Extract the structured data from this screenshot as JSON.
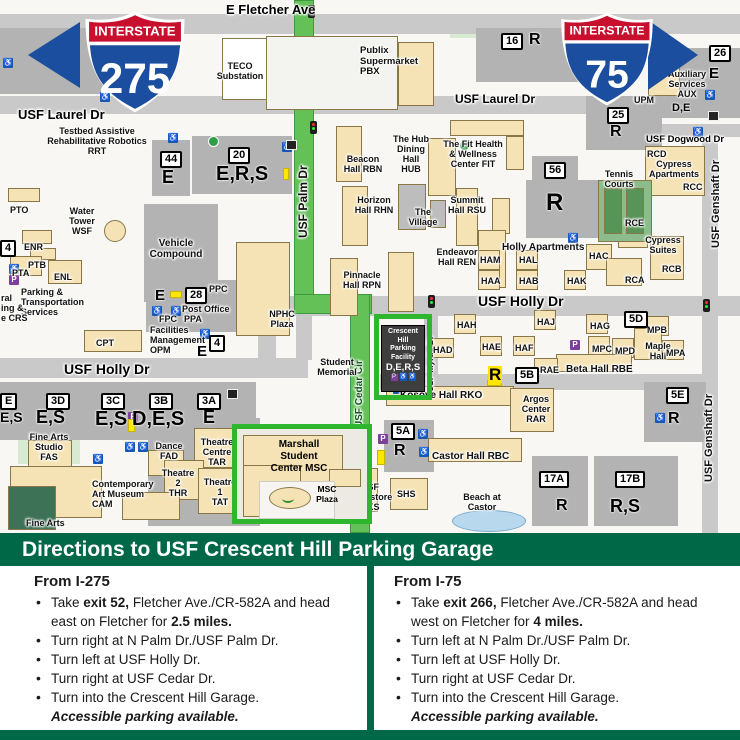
{
  "colors": {
    "usf_green": "#006747",
    "route_green": "#63c157",
    "highlight_green": "#2eb62e",
    "shield_red": "#c8102e",
    "shield_blue": "#1b4e9e"
  },
  "map": {
    "shields": {
      "i275": {
        "banner": "INTERSTATE",
        "num": "275"
      },
      "i75": {
        "banner": "INTERSTATE",
        "num": "75"
      }
    },
    "crescent": {
      "name": "Crescent\nHill\nParking\nFacility",
      "letters": "D,E,R,S"
    },
    "marshall": {
      "name": "Marshall\nStudent\nCenter MSC",
      "plaza": "MSC\nPlaza"
    },
    "labels": [
      {
        "t": "E Fletcher Ave",
        "x": 226,
        "y": 3,
        "c": "st"
      },
      {
        "t": "USF Laurel Dr",
        "x": 18,
        "y": 108,
        "c": "st"
      },
      {
        "t": "USF Laurel Dr",
        "x": 455,
        "y": 93,
        "c": "st",
        "fs": 12
      },
      {
        "t": "USF Holly Dr",
        "x": 64,
        "y": 362,
        "c": "st",
        "fs": 14
      },
      {
        "t": "USF Holly Dr",
        "x": 478,
        "y": 294,
        "c": "st",
        "fs": 14
      },
      {
        "t": "USF Dogwood Dr",
        "x": 646,
        "y": 135,
        "c": "st",
        "fs": 9.5
      },
      {
        "t": "USF Palm Dr",
        "x": 297,
        "y": 238,
        "c": "stv",
        "fs": 12
      },
      {
        "t": "USF Cedar Cir",
        "x": 354,
        "y": 428,
        "c": "stv stg",
        "fs": 10
      },
      {
        "t": "USF Myrtle Dr",
        "x": 426,
        "y": 392,
        "c": "stv",
        "fs": 8.5
      },
      {
        "t": "USF Genshaft Dr",
        "x": 710,
        "y": 248,
        "c": "stv",
        "fs": 11
      },
      {
        "t": "USF Genshaft Dr",
        "x": 703,
        "y": 482,
        "c": "stv",
        "fs": 11
      },
      {
        "t": "TECO\nSubstation",
        "x": 208,
        "y": 61,
        "w": 64
      },
      {
        "t": "Publix\nSupermarket\nPBX",
        "x": 360,
        "y": 46,
        "c": "bll",
        "fs": 9.5
      },
      {
        "t": "Testbed Assistive\nRehabilitative Robotics\nRRT",
        "x": 40,
        "y": 126,
        "w": 114
      },
      {
        "t": "The Hub\nDining\nHall\nHUB",
        "x": 388,
        "y": 134,
        "w": 46
      },
      {
        "t": "Beacon\nHall RBN",
        "x": 336,
        "y": 154,
        "w": 54
      },
      {
        "t": "The Fit Health\n& Wellness\nCenter FIT",
        "x": 440,
        "y": 139,
        "w": 66
      },
      {
        "t": "Horizon\nHall RHN",
        "x": 348,
        "y": 195,
        "w": 52
      },
      {
        "t": "The\nVillage",
        "x": 403,
        "y": 207,
        "w": 40
      },
      {
        "t": "Summit\nHall RSU",
        "x": 442,
        "y": 195,
        "w": 50
      },
      {
        "t": "Endeavor\nHall REN",
        "x": 430,
        "y": 247,
        "w": 54
      },
      {
        "t": "Pinnacle\nHall RPN",
        "x": 336,
        "y": 270,
        "w": 52
      },
      {
        "t": "Holly Apartments",
        "x": 502,
        "y": 242,
        "fs": 10
      },
      {
        "t": "HAM",
        "x": 480,
        "y": 255
      },
      {
        "t": "HAL",
        "x": 519,
        "y": 255
      },
      {
        "t": "HAA",
        "x": 481,
        "y": 276
      },
      {
        "t": "HAB",
        "x": 519,
        "y": 276
      },
      {
        "t": "HAK",
        "x": 567,
        "y": 276
      },
      {
        "t": "HAC",
        "x": 589,
        "y": 251
      },
      {
        "t": "RCE",
        "x": 625,
        "y": 218
      },
      {
        "t": "Cypress\nSuites",
        "x": 638,
        "y": 235,
        "w": 50
      },
      {
        "t": "RCB",
        "x": 662,
        "y": 264
      },
      {
        "t": "RCA",
        "x": 625,
        "y": 275
      },
      {
        "t": "RCD",
        "x": 647,
        "y": 149
      },
      {
        "t": "Cypress\nApartments",
        "x": 642,
        "y": 159,
        "w": 64
      },
      {
        "t": "RCC",
        "x": 683,
        "y": 182
      },
      {
        "t": "Tennis\nCourts",
        "x": 596,
        "y": 169,
        "w": 46
      },
      {
        "t": "Auxiliary\nServices\nAUX",
        "x": 662,
        "y": 69,
        "w": 50
      },
      {
        "t": "UPM",
        "x": 634,
        "y": 95
      },
      {
        "t": "Water\nTower\nWSF",
        "x": 58,
        "y": 206,
        "w": 48
      },
      {
        "t": "PTO",
        "x": 10,
        "y": 205
      },
      {
        "t": "ENR",
        "x": 24,
        "y": 242
      },
      {
        "t": "PTB",
        "x": 28,
        "y": 260
      },
      {
        "t": "PTA",
        "x": 12,
        "y": 268
      },
      {
        "t": "ENL",
        "x": 54,
        "y": 272
      },
      {
        "t": "Parking &\nTransportation\nServices",
        "x": 21,
        "y": 287,
        "c": "bll"
      },
      {
        "t": "ral\ning &\ne CRS",
        "x": 1,
        "y": 293,
        "c": "bll"
      },
      {
        "t": "Vehicle\nCompound",
        "x": 140,
        "y": 238,
        "w": 72,
        "fs": 10
      },
      {
        "t": "PPC",
        "x": 209,
        "y": 284
      },
      {
        "t": "Post Office",
        "x": 182,
        "y": 304
      },
      {
        "t": "FPC",
        "x": 159,
        "y": 314
      },
      {
        "t": "PPA",
        "x": 184,
        "y": 314
      },
      {
        "t": "Facilities\nManagement\nOPM",
        "x": 150,
        "y": 325,
        "c": "bll"
      },
      {
        "t": "CPT",
        "x": 96,
        "y": 338
      },
      {
        "t": "NPHC\nPlaza",
        "x": 260,
        "y": 309,
        "w": 44
      },
      {
        "t": "Student\nMemorial",
        "x": 312,
        "y": 357,
        "w": 50
      },
      {
        "t": "Fine Arts\nStudio\nFAS",
        "x": 22,
        "y": 432,
        "w": 54
      },
      {
        "t": "Dance\nFAD",
        "x": 148,
        "y": 441,
        "w": 42
      },
      {
        "t": "Theatre\nCentre\nTAR",
        "x": 192,
        "y": 437,
        "w": 50
      },
      {
        "t": "Theatre\n2\nTHR",
        "x": 158,
        "y": 468,
        "w": 40
      },
      {
        "t": "Theatre\n1\nTAT",
        "x": 198,
        "y": 477,
        "w": 44
      },
      {
        "t": "Contemporary\nArt Museum\nCAM",
        "x": 92,
        "y": 479,
        "c": "bll"
      },
      {
        "t": "Fine Arts",
        "x": 26,
        "y": 518
      },
      {
        "t": "USF\nBookstore\nBKS",
        "x": 344,
        "y": 482,
        "w": 52
      },
      {
        "t": "SHS",
        "x": 397,
        "y": 489
      },
      {
        "t": "Castor Hall RBC",
        "x": 432,
        "y": 451,
        "fs": 10
      },
      {
        "t": "Beach at\nCastor",
        "x": 455,
        "y": 492,
        "w": 54
      },
      {
        "t": "Kosove Hall RKO",
        "x": 400,
        "y": 390,
        "fs": 10
      },
      {
        "t": "Argos\nCenter\nRAR",
        "x": 515,
        "y": 394,
        "w": 42
      },
      {
        "t": "HAH",
        "x": 457,
        "y": 320
      },
      {
        "t": "HAD",
        "x": 433,
        "y": 345
      },
      {
        "t": "HAE",
        "x": 482,
        "y": 342
      },
      {
        "t": "HAF",
        "x": 515,
        "y": 343
      },
      {
        "t": "HAJ",
        "x": 537,
        "y": 317
      },
      {
        "t": "HAG",
        "x": 590,
        "y": 321
      },
      {
        "t": "MPB",
        "x": 647,
        "y": 325
      },
      {
        "t": "MPC",
        "x": 592,
        "y": 344
      },
      {
        "t": "MPD",
        "x": 615,
        "y": 346
      },
      {
        "t": "Maple\nHall",
        "x": 638,
        "y": 341,
        "w": 40
      },
      {
        "t": "MPA",
        "x": 666,
        "y": 348
      },
      {
        "t": "RAE",
        "x": 540,
        "y": 365
      },
      {
        "t": "Beta Hall RBE",
        "x": 566,
        "y": 364,
        "fs": 10
      }
    ],
    "parking_letters": [
      [
        "E",
        162,
        168,
        18
      ],
      [
        "E,R,S",
        216,
        164,
        20
      ],
      [
        "R",
        529,
        32,
        16
      ],
      [
        "E",
        709,
        66,
        15
      ],
      [
        "D,E",
        672,
        103,
        11
      ],
      [
        "R",
        610,
        124,
        16
      ],
      [
        "R",
        546,
        191,
        24
      ],
      [
        "E",
        155,
        288,
        15
      ],
      [
        "E",
        197,
        344,
        15
      ],
      [
        "E,S",
        0,
        410,
        14
      ],
      [
        "E,S",
        36,
        408,
        18
      ],
      [
        "E,S",
        95,
        409,
        20
      ],
      [
        "D,E,S",
        132,
        409,
        20
      ],
      [
        "E",
        203,
        408,
        18
      ],
      [
        "R",
        488,
        366,
        17,
        1
      ],
      [
        "R",
        394,
        443,
        16
      ],
      [
        "R",
        668,
        411,
        16
      ],
      [
        "R",
        556,
        498,
        16
      ],
      [
        "R,S",
        610,
        497,
        18
      ]
    ],
    "badges": [
      [
        "16",
        501,
        33
      ],
      [
        "26",
        709,
        45
      ],
      [
        "25",
        607,
        107
      ],
      [
        "56",
        544,
        162
      ],
      [
        "44",
        160,
        151
      ],
      [
        "20",
        228,
        147
      ],
      [
        "28",
        185,
        287
      ],
      [
        "4",
        209,
        335
      ],
      [
        "4",
        0,
        240
      ],
      [
        "E",
        0,
        393
      ],
      [
        "3D",
        46,
        393
      ],
      [
        "3C",
        101,
        393
      ],
      [
        "3B",
        149,
        393
      ],
      [
        "3A",
        197,
        393
      ],
      [
        "5D",
        624,
        311
      ],
      [
        "5B",
        515,
        367
      ],
      [
        "5A",
        391,
        423
      ],
      [
        "5E",
        666,
        387
      ],
      [
        "17A",
        539,
        471
      ],
      [
        "17B",
        615,
        471
      ]
    ],
    "icons": {
      "acc": [
        [
          3,
          58
        ],
        [
          100,
          92
        ],
        [
          168,
          133
        ],
        [
          282,
          142
        ],
        [
          152,
          306
        ],
        [
          171,
          306
        ],
        [
          200,
          329
        ],
        [
          9,
          264
        ],
        [
          125,
          442
        ],
        [
          138,
          442
        ],
        [
          93,
          454
        ],
        [
          418,
          429
        ],
        [
          419,
          447
        ],
        [
          568,
          233
        ],
        [
          705,
          90
        ],
        [
          693,
          127
        ],
        [
          655,
          413
        ],
        [
          393,
          384
        ]
      ],
      "p": [
        [
          9,
          275
        ],
        [
          128,
          412
        ],
        [
          378,
          434
        ],
        [
          570,
          340
        ]
      ],
      "tl": [
        [
          308,
          5
        ],
        [
          310,
          121
        ],
        [
          428,
          295
        ],
        [
          703,
          299
        ]
      ],
      "y": [
        [
          170,
          291,
          12,
          7
        ],
        [
          283,
          168,
          6,
          12
        ],
        [
          128,
          419,
          7,
          13
        ],
        [
          377,
          450,
          8,
          15
        ],
        [
          487,
          380,
          15,
          6
        ]
      ],
      "g": [
        [
          208,
          136
        ],
        [
          459,
          140
        ]
      ],
      "dk": [
        [
          286,
          140
        ],
        [
          708,
          111
        ],
        [
          227,
          389
        ]
      ]
    }
  },
  "directions": {
    "header": "Directions to USF Crescent Hill Parking Garage",
    "left": {
      "title": "From I-275",
      "bullets": [
        [
          {
            "t": "Take "
          },
          {
            "t": "exit 52,",
            "b": 1
          },
          {
            "t": " Fletcher Ave./CR-582A and head east on Fletcher for "
          },
          {
            "t": "2.5 miles.",
            "b": 1
          }
        ],
        [
          {
            "t": "Turn right at N Palm Dr./USF Palm Dr."
          }
        ],
        [
          {
            "t": "Turn left at USF Holly Dr."
          }
        ],
        [
          {
            "t": "Turn right at USF Cedar Dr."
          }
        ],
        [
          {
            "t": "Turn into the Crescent Hill Garage."
          },
          {
            "t": "Accessible parking available.",
            "b": 1,
            "i": 1,
            "br": 1
          }
        ]
      ]
    },
    "right": {
      "title": "From I-75",
      "bullets": [
        [
          {
            "t": "Take "
          },
          {
            "t": "exit 266,",
            "b": 1
          },
          {
            "t": " Fletcher Ave./CR-582A and head west on Fletcher for "
          },
          {
            "t": "4 miles.",
            "b": 1
          }
        ],
        [
          {
            "t": "Turn left at N Palm Dr./USF Palm Dr."
          }
        ],
        [
          {
            "t": "Turn left at USF Holly Dr."
          }
        ],
        [
          {
            "t": "Turn right at USF Cedar Dr."
          }
        ],
        [
          {
            "t": "Turn into the Crescent Hill Garage."
          },
          {
            "t": "Accessible parking available.",
            "b": 1,
            "i": 1,
            "br": 1
          }
        ]
      ]
    }
  }
}
